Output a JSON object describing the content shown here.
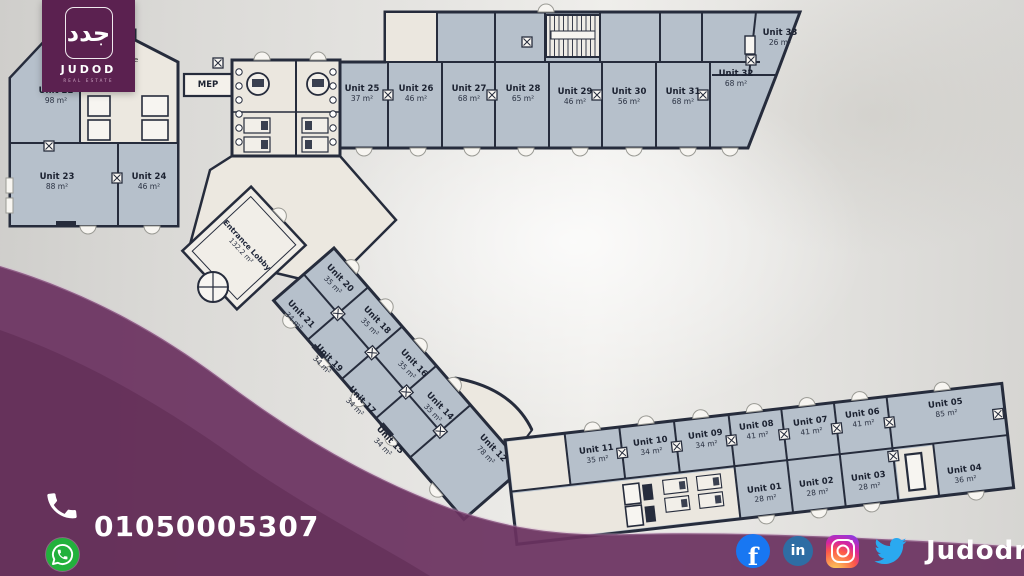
{
  "brand": {
    "name": "JUDOD",
    "subtitle": "REAL ESTATE",
    "arabic_mark": "جدد"
  },
  "contact": {
    "phone": "01050005307",
    "phone_icon": "phone-handset-icon",
    "whatsapp_icon": "whatsapp-icon"
  },
  "social": {
    "handle": "Judodre",
    "icons": [
      {
        "name": "facebook-icon",
        "glyph": "f",
        "color": "#1877f2"
      },
      {
        "name": "linkedin-icon",
        "glyph": "in",
        "color": "#2e6da4"
      },
      {
        "name": "instagram-icon",
        "color": "gradient"
      },
      {
        "name": "twitter-icon",
        "color": "#2aa9f0"
      }
    ]
  },
  "plan": {
    "mep_label": "MEP",
    "partial_label": "ce",
    "lobby": {
      "label": "Entrance Lobby",
      "area": "132.2 m²",
      "x": 244,
      "y": 248,
      "r": 47
    },
    "units": [
      {
        "label": "Unit 22",
        "area": "98 m²",
        "x": 56,
        "y": 96,
        "r": 0
      },
      {
        "label": "Unit 23",
        "area": "88 m²",
        "x": 57,
        "y": 182,
        "r": 0
      },
      {
        "label": "Unit 24",
        "area": "46 m²",
        "x": 149,
        "y": 182,
        "r": 0
      },
      {
        "label": "Unit 25",
        "area": "37 m²",
        "x": 362,
        "y": 94,
        "r": 0
      },
      {
        "label": "Unit 26",
        "area": "46 m²",
        "x": 416,
        "y": 94,
        "r": 0
      },
      {
        "label": "Unit 27",
        "area": "68 m²",
        "x": 469,
        "y": 94,
        "r": 0
      },
      {
        "label": "Unit 28",
        "area": "65 m²",
        "x": 523,
        "y": 94,
        "r": 0
      },
      {
        "label": "Unit 29",
        "area": "46 m²",
        "x": 575,
        "y": 97,
        "r": 0
      },
      {
        "label": "Unit 30",
        "area": "56 m²",
        "x": 629,
        "y": 97,
        "r": 0
      },
      {
        "label": "Unit 31",
        "area": "68 m²",
        "x": 683,
        "y": 97,
        "r": 0
      },
      {
        "label": "Unit 32",
        "area": "68 m²",
        "x": 736,
        "y": 79,
        "r": 0
      },
      {
        "label": "Unit 33",
        "area": "26 m²",
        "x": 780,
        "y": 38,
        "r": 0
      },
      {
        "label": "Unit 20",
        "area": "35 m²",
        "x": 336,
        "y": 282,
        "r": 46
      },
      {
        "label": "Unit 21",
        "area": "34 m²",
        "x": 297,
        "y": 318,
        "r": 46
      },
      {
        "label": "Unit 18",
        "area": "35 m²",
        "x": 373,
        "y": 324,
        "r": 46
      },
      {
        "label": "Unit 19",
        "area": "34 m²",
        "x": 325,
        "y": 362,
        "r": 46
      },
      {
        "label": "Unit 16",
        "area": "35 m²",
        "x": 410,
        "y": 367,
        "r": 46
      },
      {
        "label": "Unit 17",
        "area": "34 m²",
        "x": 358,
        "y": 404,
        "r": 46
      },
      {
        "label": "Unit 14",
        "area": "35 m²",
        "x": 436,
        "y": 410,
        "r": 46
      },
      {
        "label": "Unit 15",
        "area": "34 m²",
        "x": 386,
        "y": 444,
        "r": 46
      },
      {
        "label": "Unit 12",
        "area": "78 m²",
        "x": 489,
        "y": 452,
        "r": 46
      },
      {
        "label": "Unit 11",
        "area": "35 m²",
        "x": 597,
        "y": 455,
        "r": -7
      },
      {
        "label": "Unit 10",
        "area": "34 m²",
        "x": 651,
        "y": 447,
        "r": -7
      },
      {
        "label": "Unit 09",
        "area": "34 m²",
        "x": 706,
        "y": 440,
        "r": -7
      },
      {
        "label": "Unit 08",
        "area": "41 m²",
        "x": 757,
        "y": 431,
        "r": -7
      },
      {
        "label": "Unit 07",
        "area": "41 m²",
        "x": 811,
        "y": 427,
        "r": -7
      },
      {
        "label": "Unit 06",
        "area": "41 m²",
        "x": 863,
        "y": 419,
        "r": -7
      },
      {
        "label": "Unit 05",
        "area": "85 m²",
        "x": 946,
        "y": 409,
        "r": -7
      },
      {
        "label": "Unit 01",
        "area": "28 m²",
        "x": 765,
        "y": 494,
        "r": -7
      },
      {
        "label": "Unit 02",
        "area": "28 m²",
        "x": 817,
        "y": 488,
        "r": -7
      },
      {
        "label": "Unit 03",
        "area": "28 m²",
        "x": 869,
        "y": 482,
        "r": -7
      },
      {
        "label": "Unit 04",
        "area": "36 m²",
        "x": 965,
        "y": 475,
        "r": -7
      }
    ]
  },
  "colors": {
    "purple_band": "#6a3260",
    "logo_purple": "#5b2150",
    "unit_fill": "#b6c0cb",
    "service_fill": "#ebe7df",
    "wall": "#262c3c",
    "whatsapp_green": "#22b13c"
  }
}
